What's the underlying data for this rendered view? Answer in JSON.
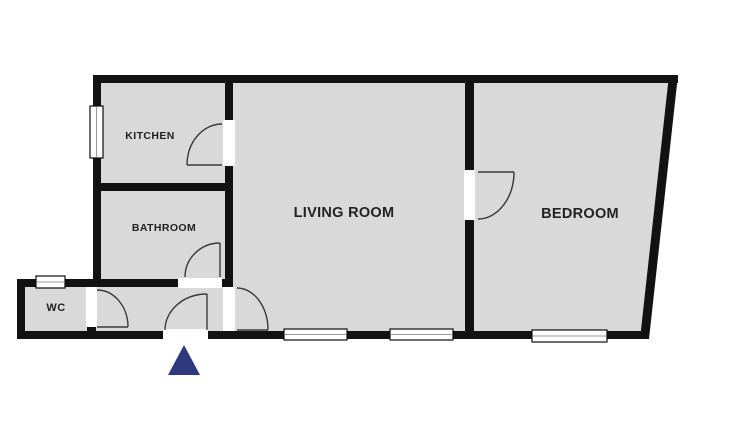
{
  "floorplan": {
    "title": "Apartment floor plan",
    "labels": {
      "kitchen": "KITCHEN",
      "bathroom": "BATHROOM",
      "wc": "WC",
      "living_room": "LIVING ROOM",
      "bedroom": "BEDROOM"
    },
    "rooms": [
      {
        "name": "Kitchen",
        "label": "KITCHEN"
      },
      {
        "name": "Bathroom",
        "label": "BATHROOM"
      },
      {
        "name": "WC",
        "label": "WC"
      },
      {
        "name": "Living Room",
        "label": "LIVING ROOM"
      },
      {
        "name": "Bedroom",
        "label": "BEDROOM"
      }
    ],
    "features": {
      "doors": [
        "kitchen-door",
        "bathroom-door",
        "wc-door",
        "entrance-door",
        "hallway-living-room-door",
        "bedroom-door"
      ],
      "windows": [
        "kitchen-window",
        "wc-window",
        "living-room-window-1",
        "living-room-window-2",
        "bedroom-window"
      ],
      "entrance_marker": "blue triangle arrow below entrance door"
    },
    "colors": {
      "background": "#ffffff",
      "wall": "#121212",
      "floor": "#d9d9d9",
      "door_arc": "#3a3a3a",
      "window_fill": "#ffffff",
      "window_frame": "#0e0e0e",
      "label_text": "#222222",
      "entrance_marker": "#2e3a7d"
    }
  }
}
